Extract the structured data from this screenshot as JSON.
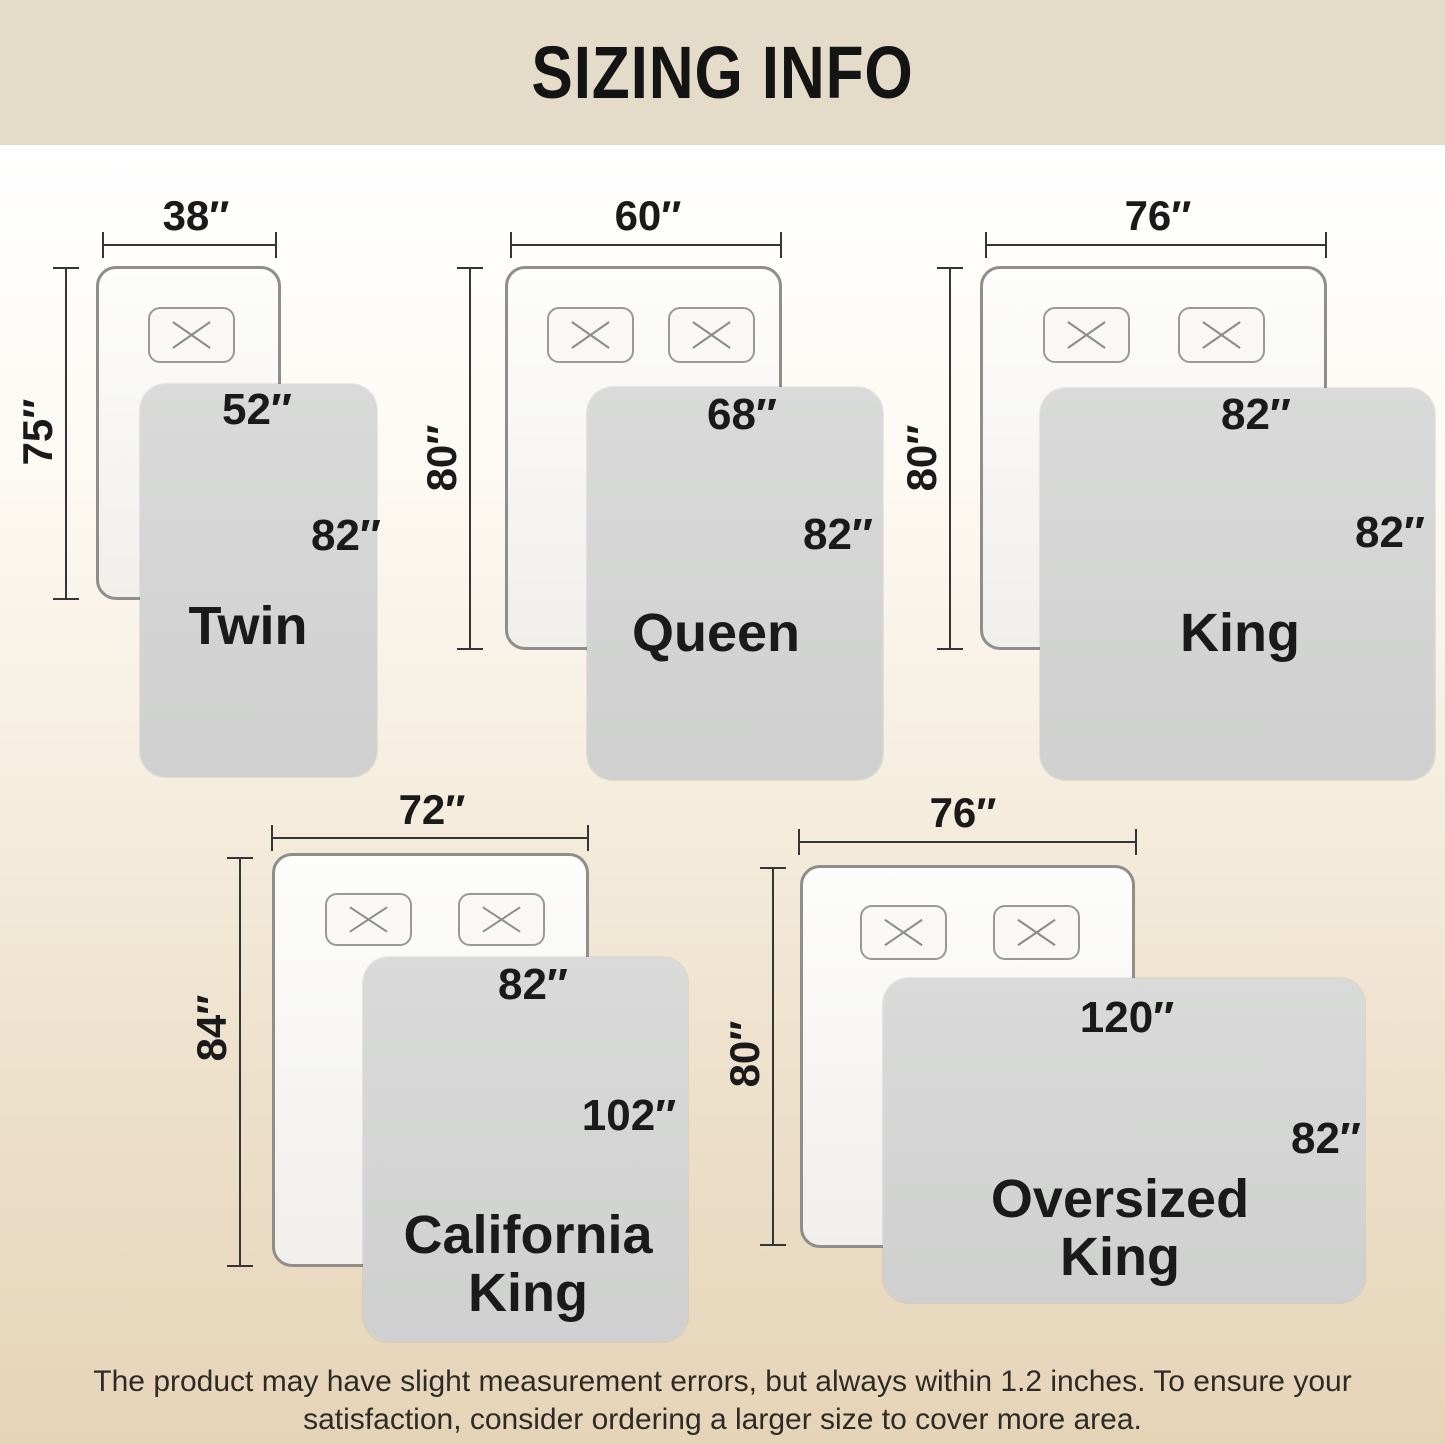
{
  "title": "SIZING INFO",
  "note": "The product may have slight measurement errors, but always within 1.2 inches. To ensure your satisfaction, consider ordering a larger size to cover more area.",
  "colors": {
    "header_bg": "#e4dbc9",
    "canvas_top": "#ffffff",
    "canvas_bottom": "#e6d4b8",
    "blanket": "#d4d5d4",
    "bed_fill": "#f7f6f4",
    "bed_border": "#8f8e8a",
    "pillow_border": "#9b9995",
    "dim_line": "#353535",
    "text": "#1a1a1a",
    "note_text": "#2e2b26"
  },
  "sizes": [
    {
      "name": "Twin",
      "name_lines": [
        "Twin"
      ],
      "bed_width_label": "38″",
      "bed_height_label": "75″",
      "blanket_width_label": "52″",
      "blanket_height_label": "82″",
      "pillow_count": 1,
      "layout": {
        "dim_h": {
          "x1": 102,
          "x2": 277,
          "y": 245,
          "label_cx": 196,
          "label_cy": 216
        },
        "dim_v": {
          "x": 66,
          "y1": 267,
          "y2": 600,
          "label_cx": 38,
          "label_cy": 432
        },
        "bed": {
          "x": 96,
          "y": 266,
          "w": 185,
          "h": 334
        },
        "pillows": {
          "y": 307,
          "w": 87,
          "h": 56,
          "xs": [
            148
          ]
        },
        "blanket": {
          "x": 140,
          "y": 384,
          "w": 237,
          "h": 393
        },
        "wlabel": {
          "cx": 257,
          "cy": 410
        },
        "hlabel": {
          "cx": 346,
          "cy": 536
        },
        "name": {
          "cx": 248,
          "cy": 626
        }
      }
    },
    {
      "name": "Queen",
      "name_lines": [
        "Queen"
      ],
      "bed_width_label": "60″",
      "bed_height_label": "80″",
      "blanket_width_label": "68″",
      "blanket_height_label": "82″",
      "pillow_count": 2,
      "layout": {
        "dim_h": {
          "x1": 510,
          "x2": 782,
          "y": 245,
          "label_cx": 648,
          "label_cy": 216
        },
        "dim_v": {
          "x": 470,
          "y1": 267,
          "y2": 650,
          "label_cx": 442,
          "label_cy": 458
        },
        "bed": {
          "x": 505,
          "y": 266,
          "w": 277,
          "h": 384
        },
        "pillows": {
          "y": 307,
          "w": 87,
          "h": 56,
          "xs": [
            547,
            668
          ]
        },
        "blanket": {
          "x": 587,
          "y": 387,
          "w": 296,
          "h": 393
        },
        "wlabel": {
          "cx": 742,
          "cy": 415
        },
        "hlabel": {
          "cx": 838,
          "cy": 535
        },
        "name": {
          "cx": 716,
          "cy": 633
        }
      }
    },
    {
      "name": "King",
      "name_lines": [
        "King"
      ],
      "bed_width_label": "76″",
      "bed_height_label": "80″",
      "blanket_width_label": "82″",
      "blanket_height_label": "82″",
      "pillow_count": 2,
      "layout": {
        "dim_h": {
          "x1": 985,
          "x2": 1327,
          "y": 245,
          "label_cx": 1158,
          "label_cy": 216
        },
        "dim_v": {
          "x": 950,
          "y1": 267,
          "y2": 650,
          "label_cx": 922,
          "label_cy": 458
        },
        "bed": {
          "x": 980,
          "y": 266,
          "w": 347,
          "h": 384
        },
        "pillows": {
          "y": 307,
          "w": 87,
          "h": 56,
          "xs": [
            1043,
            1178
          ]
        },
        "blanket": {
          "x": 1040,
          "y": 388,
          "w": 395,
          "h": 392
        },
        "wlabel": {
          "cx": 1256,
          "cy": 415
        },
        "hlabel": {
          "cx": 1390,
          "cy": 533
        },
        "name": {
          "cx": 1240,
          "cy": 633
        }
      }
    },
    {
      "name": "California King",
      "name_lines": [
        "California",
        "King"
      ],
      "bed_width_label": "72″",
      "bed_height_label": "84″",
      "blanket_width_label": "82″",
      "blanket_height_label": "102″",
      "pillow_count": 2,
      "layout": {
        "dim_h": {
          "x1": 271,
          "x2": 589,
          "y": 838,
          "label_cx": 432,
          "label_cy": 810
        },
        "dim_v": {
          "x": 240,
          "y1": 857,
          "y2": 1267,
          "label_cx": 212,
          "label_cy": 1028
        },
        "bed": {
          "x": 272,
          "y": 853,
          "w": 317,
          "h": 414
        },
        "pillows": {
          "y": 893,
          "w": 87,
          "h": 53,
          "xs": [
            325,
            458
          ]
        },
        "blanket": {
          "x": 363,
          "y": 957,
          "w": 325,
          "h": 385
        },
        "wlabel": {
          "cx": 533,
          "cy": 985
        },
        "hlabel": {
          "cx": 629,
          "cy": 1116
        },
        "name": {
          "cx": 528,
          "cy": 1264
        }
      }
    },
    {
      "name": "Oversized King",
      "name_lines": [
        "Oversized",
        "King"
      ],
      "bed_width_label": "76″",
      "bed_height_label": "80″",
      "blanket_width_label": "120″",
      "blanket_height_label": "82″",
      "pillow_count": 2,
      "layout": {
        "dim_h": {
          "x1": 798,
          "x2": 1137,
          "y": 842,
          "label_cx": 963,
          "label_cy": 813
        },
        "dim_v": {
          "x": 773,
          "y1": 867,
          "y2": 1246,
          "label_cx": 745,
          "label_cy": 1054
        },
        "bed": {
          "x": 800,
          "y": 865,
          "w": 335,
          "h": 383
        },
        "pillows": {
          "y": 905,
          "w": 87,
          "h": 55,
          "xs": [
            860,
            993
          ]
        },
        "blanket": {
          "x": 883,
          "y": 978,
          "w": 482,
          "h": 325
        },
        "wlabel": {
          "cx": 1127,
          "cy": 1018
        },
        "hlabel": {
          "cx": 1326,
          "cy": 1139
        },
        "name": {
          "cx": 1120,
          "cy": 1228
        }
      }
    }
  ]
}
